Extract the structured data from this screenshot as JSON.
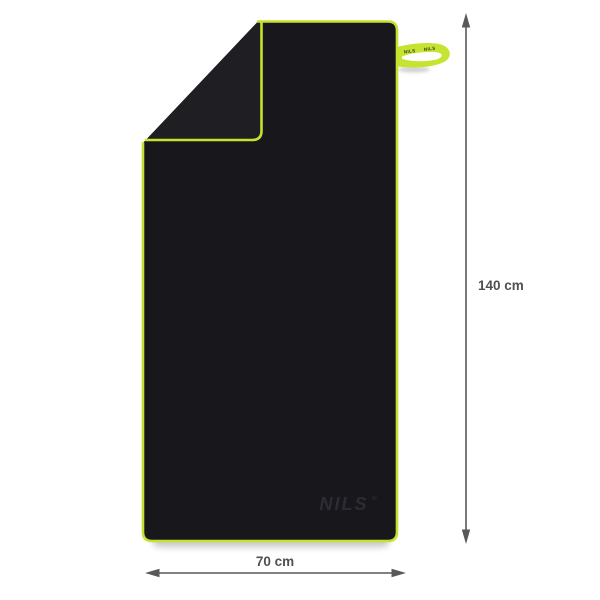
{
  "towel": {
    "logo_text": "NILS",
    "registered_mark": "®",
    "strap_text_1": "NILS",
    "strap_text_2": "NILS"
  },
  "dimensions": {
    "height_label": "140 cm",
    "width_label": "70 cm"
  },
  "colors": {
    "background": "#ffffff",
    "towel": "#18181c",
    "towel_fold": "#1e1e23",
    "border": "#c3e32e",
    "strap": "#c4e431",
    "strap_hole": "#ffffff",
    "strap_text": "#3a3a22",
    "logo": "#2c2c34",
    "dimension": "#57585a",
    "label": "#4f5052"
  }
}
